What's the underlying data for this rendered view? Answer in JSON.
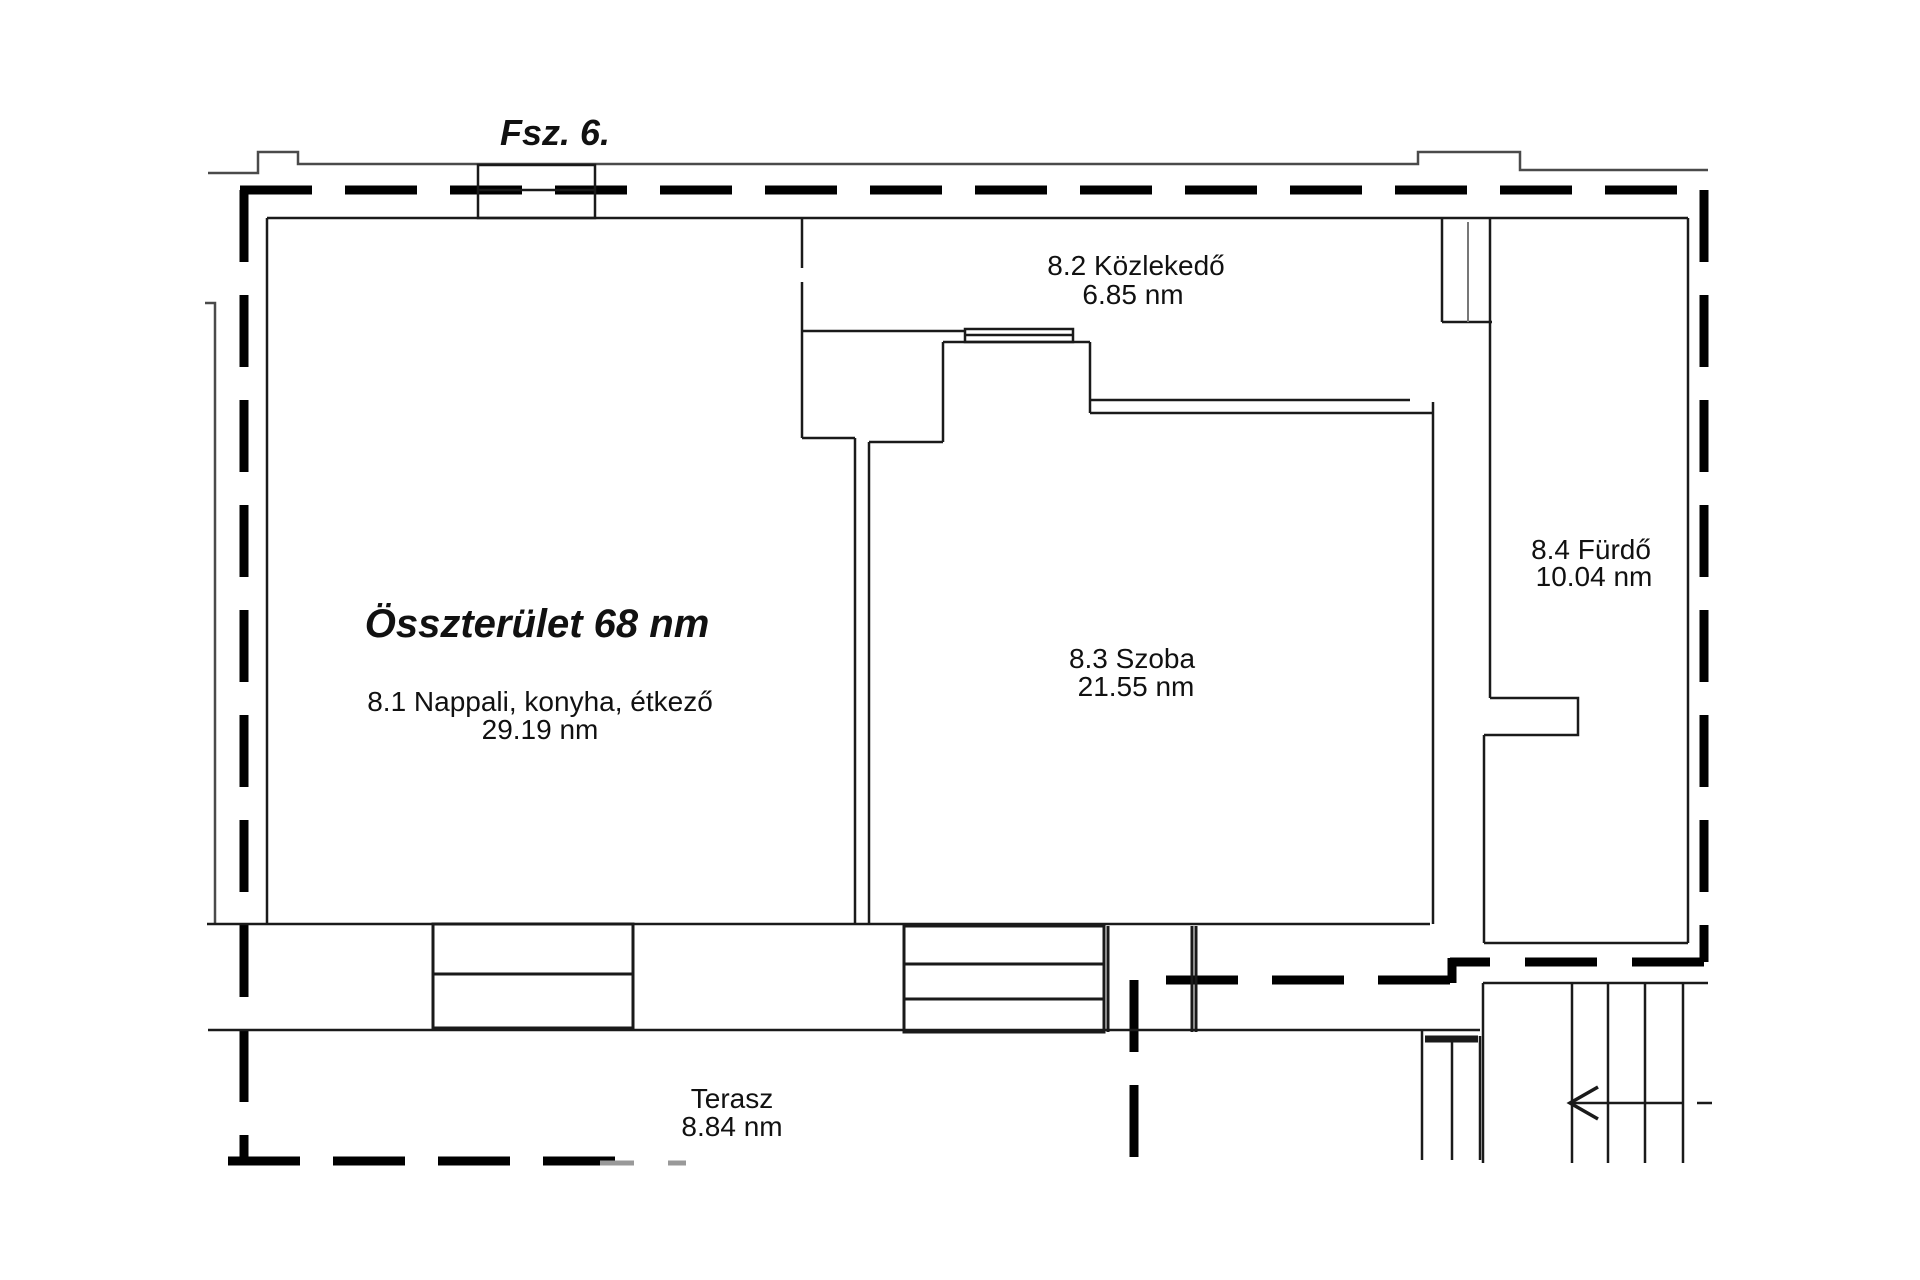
{
  "title": "Fsz. 6.",
  "total_area_label": "Összterület 68 nm",
  "rooms": [
    {
      "id": "8.1",
      "label": "8.1 Nappali, konyha, étkező",
      "area": "29.19 nm"
    },
    {
      "id": "8.2",
      "label": "8.2 Közlekedő",
      "area": "6.85 nm"
    },
    {
      "id": "8.3",
      "label": "8.3 Szoba",
      "area": "21.55 nm"
    },
    {
      "id": "8.4",
      "label": "8.4 Fürdő",
      "area": "10.04 nm"
    }
  ],
  "terrace": {
    "label": "Terasz",
    "area": "8.84 nm"
  },
  "colors": {
    "background": "#ffffff",
    "wall": "#1a1a1a",
    "boundary_dash": "#000000",
    "faded_line": "#8a8a8a",
    "text": "#111111"
  }
}
